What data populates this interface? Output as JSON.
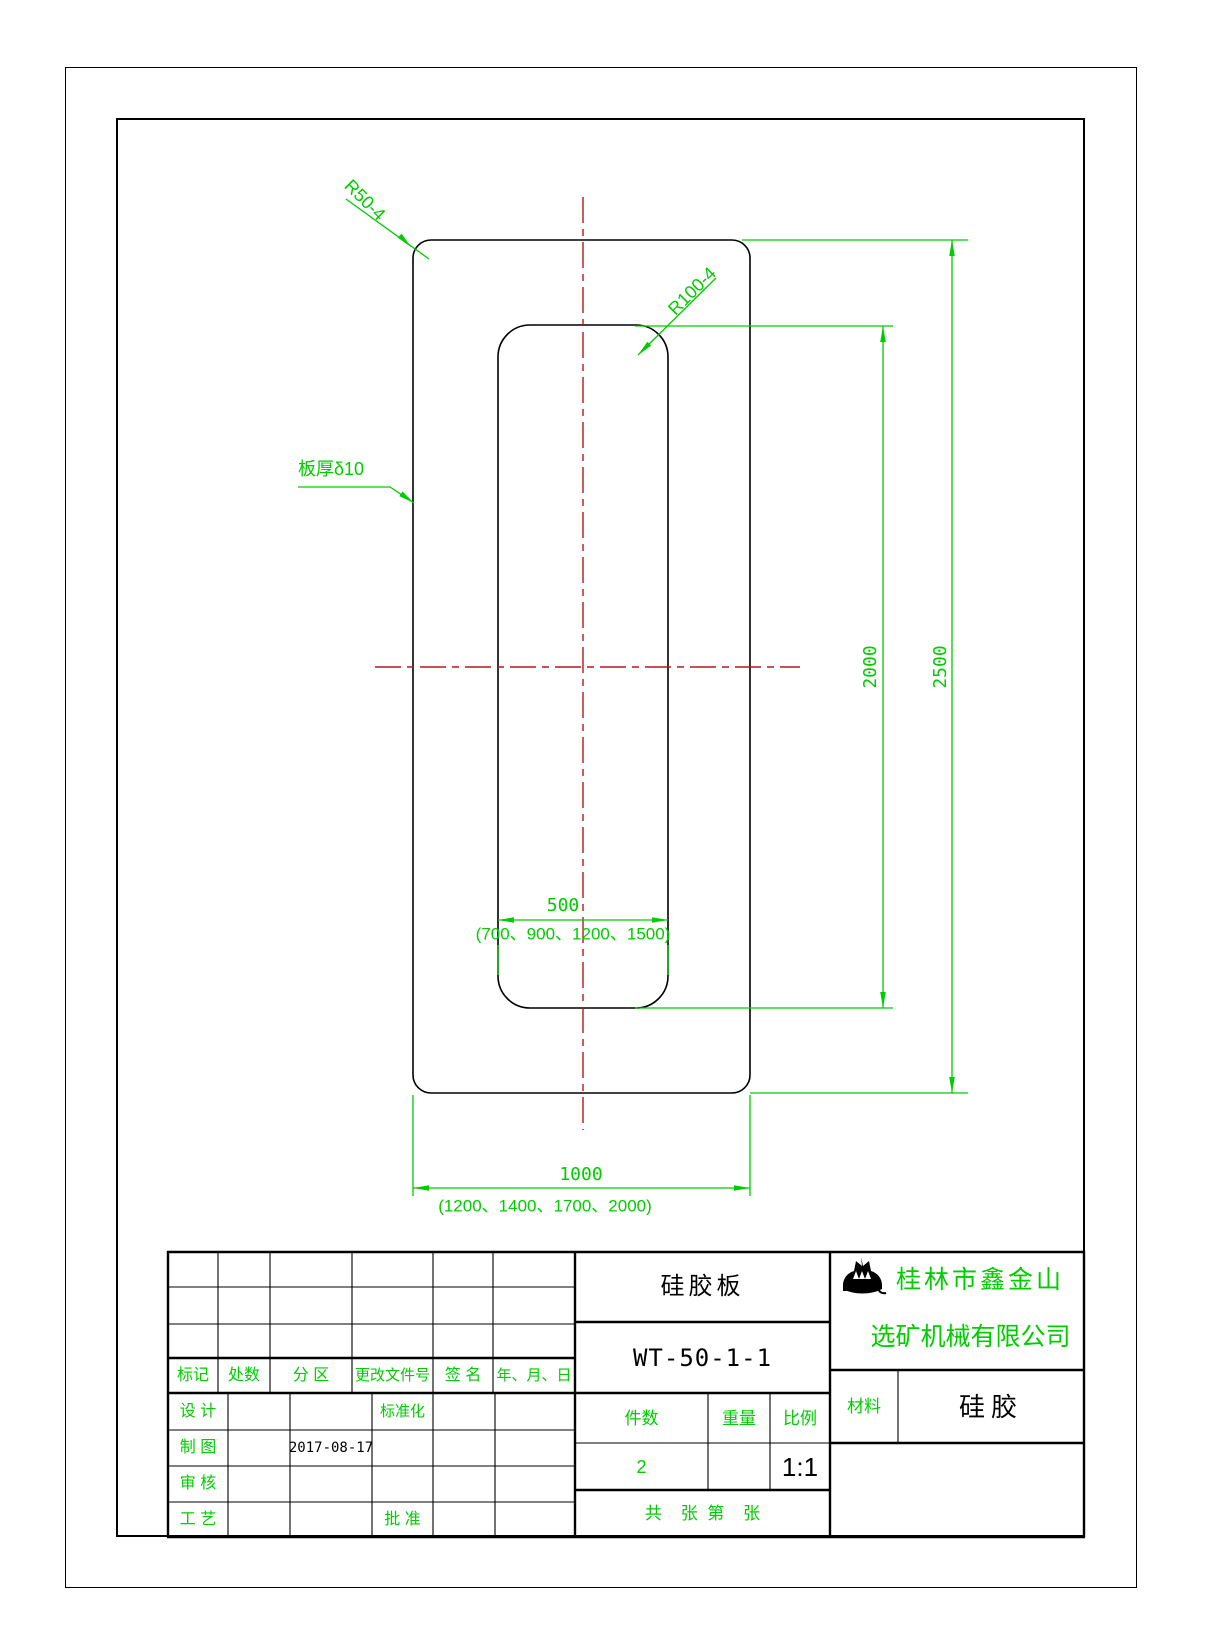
{
  "drawing": {
    "annotations": {
      "corner_radius_outer": "R50-4",
      "corner_radius_inner": "R100-4",
      "thickness": "板厚δ10"
    },
    "dimensions": {
      "inner_width": "500",
      "inner_width_options": "(700、900、1200、1500)",
      "outer_width": "1000",
      "outer_width_options": "(1200、1400、1700、2000)",
      "inner_height": "2000",
      "outer_height": "2500"
    },
    "colors": {
      "dimension_green": "#00cc00",
      "centerline_red": "#b01a1a",
      "outline_black": "#000000"
    }
  },
  "title_block": {
    "part_name": "硅胶板",
    "drawing_no": "WT-50-1-1",
    "company": {
      "line1": "桂林市鑫金山",
      "line2": "选矿机械有限公司",
      "logo": "crown-mountain-logo"
    },
    "material": {
      "label": "材料",
      "value": "硅胶"
    },
    "quantity": {
      "label": "件数",
      "value": "2"
    },
    "weight": {
      "label": "重量"
    },
    "scale": {
      "label": "比例",
      "value": "1:1"
    },
    "sheet_count": "共    张  第    张",
    "revision_header": {
      "mark": "标记",
      "count": "处数",
      "zone": "分 区",
      "doc_no": "更改文件号",
      "signature": "签 名",
      "date": "年、月、日"
    },
    "roles": {
      "design": "设 计",
      "standardization": "标准化",
      "draft": "制 图",
      "draft_date": "2017-08-17",
      "check": "审 核",
      "process": "工 艺",
      "approve": "批 准"
    }
  }
}
